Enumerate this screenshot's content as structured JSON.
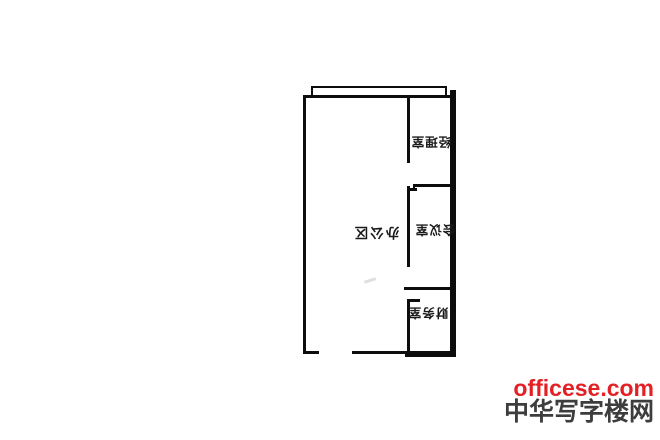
{
  "floor_plan": {
    "wall_color": "#0d0d0d",
    "text_rotation_deg": 180,
    "rooms": [
      {
        "id": "office-area",
        "label": "办公区"
      },
      {
        "id": "manager-room",
        "label": "经理室"
      },
      {
        "id": "meeting-room",
        "label": "会议室"
      },
      {
        "id": "finance-room",
        "label": "财务室"
      }
    ]
  },
  "watermark": {
    "site": "officese.com",
    "site_color": "#e32124",
    "portal_name": "中华写字楼网",
    "portal_color": "#3d3d3d"
  }
}
